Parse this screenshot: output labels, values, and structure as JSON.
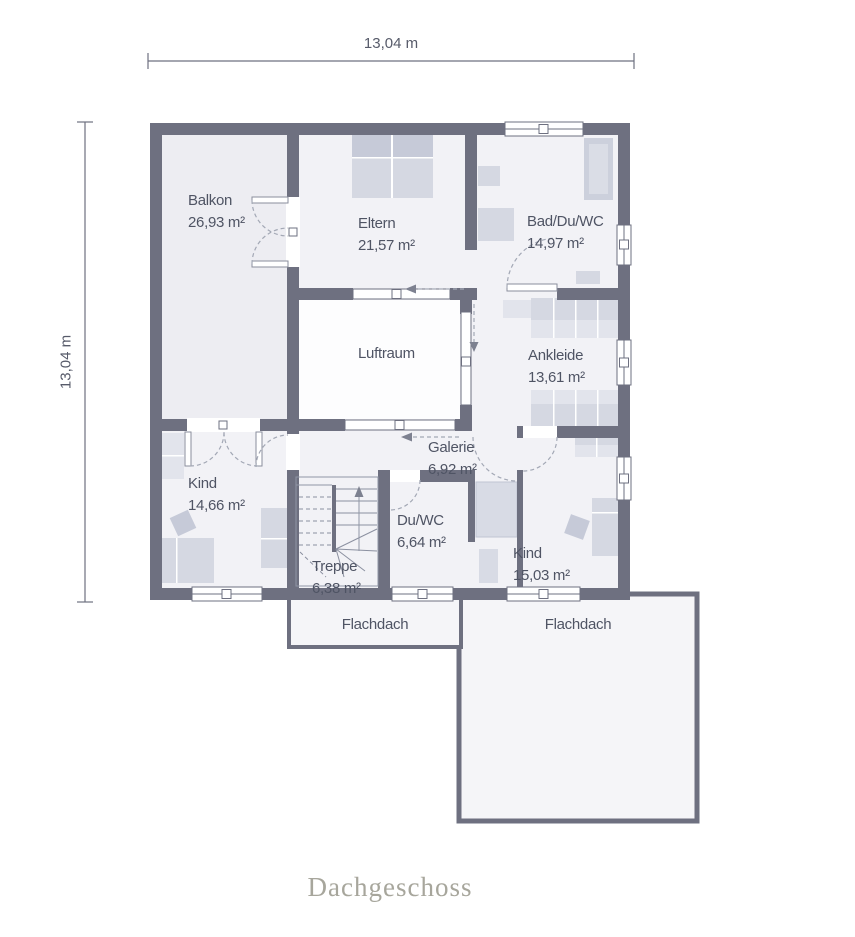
{
  "title": "Dachgeschoss",
  "dimensions": {
    "width": "13,04 m",
    "height": "13,04 m"
  },
  "rooms": {
    "balkon": {
      "name": "Balkon",
      "area": "26,93 m²"
    },
    "eltern": {
      "name": "Eltern",
      "area": "21,57 m²"
    },
    "bad_du_wc": {
      "name": "Bad/Du/WC",
      "area": "14,97 m²"
    },
    "luftraum": {
      "name": "Luftraum"
    },
    "ankleide": {
      "name": "Ankleide",
      "area": "13,61 m²"
    },
    "galerie": {
      "name": "Galerie",
      "area": "6,92 m²"
    },
    "kind_west": {
      "name": "Kind",
      "area": "14,66 m²"
    },
    "du_wc": {
      "name": "Du/WC",
      "area": "6,64 m²"
    },
    "treppe": {
      "name": "Treppe",
      "area": "6,38 m²"
    },
    "kind_sued": {
      "name": "Kind",
      "area": "15,03 m²"
    },
    "flachdach_klein": {
      "name": "Flachdach"
    },
    "flachdach_gross": {
      "name": "Flachdach"
    }
  },
  "colors": {
    "wall": "#6e7080",
    "floor": "#f2f2f6",
    "balcony": "#ededf2",
    "void": "#fdfdfe",
    "roof": "#f5f5f8",
    "furn": "#d5d8e2",
    "furnDark": "#c6cad8",
    "furnLight": "#e2e4ec",
    "dash": "#a3a8b5",
    "text": "#4f5464",
    "dim": "#575b6a",
    "title": "#a7a69c"
  }
}
